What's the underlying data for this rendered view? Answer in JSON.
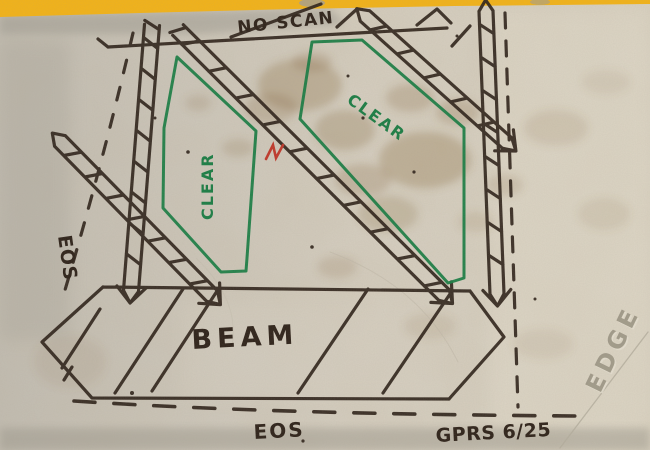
{
  "annotations": {
    "no_scan": "NO SCAN",
    "clear_left": "CLEAR",
    "clear_right": "CLEAR",
    "eos_left": "EOS",
    "eos_bottom": "EOS",
    "beam": "BEAM",
    "signature": "GPRS 6/25",
    "edge": "EDGE"
  },
  "colors": {
    "warning_stripe_yellow": "#f3b318",
    "marker_ink": "#2e2219",
    "clear_green": "#1a7d44",
    "red_mark": "#c0392b",
    "concrete_base": "#cfc9bc",
    "etched_text": "#97907f"
  }
}
